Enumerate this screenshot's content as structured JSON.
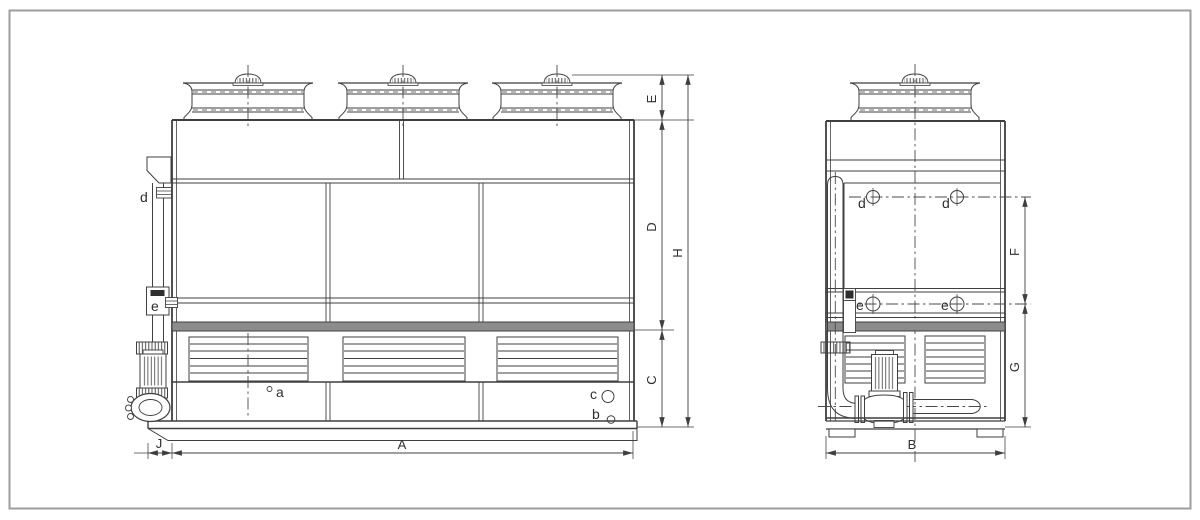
{
  "drawing": {
    "colors": {
      "line": "#3f3f3f",
      "band": "#8c8c8c",
      "page_border": "#9e9e9e",
      "background": "#ffffff"
    },
    "front_view": {
      "dims": {
        "A": "A",
        "C": "C",
        "D": "D",
        "E": "E",
        "H": "H",
        "J": "J"
      },
      "connections": {
        "a": "a",
        "b": "b",
        "c": "c",
        "d": "d",
        "e": "e"
      }
    },
    "side_view": {
      "dims": {
        "B": "B",
        "F": "F",
        "G": "G"
      },
      "connections": {
        "d_left": "d",
        "d_right": "d",
        "e_left": "e",
        "e_right": "e"
      }
    }
  }
}
